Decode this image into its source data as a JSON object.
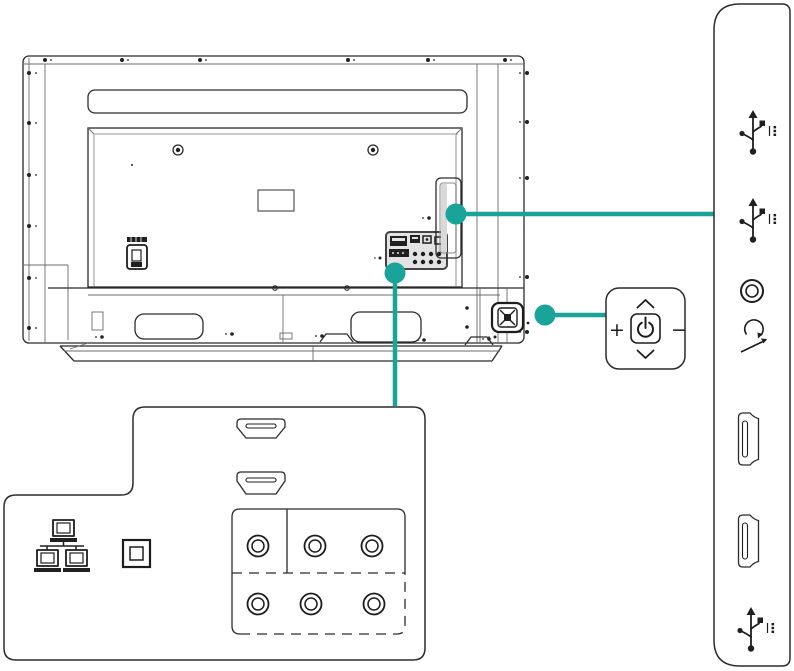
{
  "diagram": {
    "title": "TV rear panel connections diagram",
    "accent_color": "#1AA398",
    "line_color": "#2B2B2B",
    "tv": {
      "view": "rear",
      "features": [
        "speaker-grille-slot",
        "vesa-mount-holes",
        "rating-label",
        "service-port",
        "rear-port-cluster",
        "side-port-cover",
        "power-joystick-button",
        "stand-base"
      ]
    },
    "side_panel": {
      "ports": [
        {
          "icon": "usb-icon",
          "name": "usb-port-1"
        },
        {
          "icon": "usb-icon",
          "name": "usb-port-2"
        },
        {
          "icon": "audio-jack-icon",
          "name": "audio-out-jack"
        },
        {
          "icon": "av-in-icon",
          "name": "av-input"
        },
        {
          "icon": "hdmi-icon",
          "name": "hdmi-port-1"
        },
        {
          "icon": "hdmi-icon",
          "name": "hdmi-port-2"
        },
        {
          "icon": "usb-icon",
          "name": "usb-port-3"
        }
      ]
    },
    "control_panel": {
      "plus_label": "+",
      "minus_label": "−",
      "power_icon": "power-symbol",
      "up_icon": "chevron-up",
      "down_icon": "chevron-down"
    },
    "bottom_panel": {
      "ports": [
        {
          "icon": "ethernet-icon",
          "name": "lan-port"
        },
        {
          "icon": "optical-audio-icon",
          "name": "digital-audio-out"
        },
        {
          "icon": "hdmi-icon",
          "name": "hdmi-port-3"
        },
        {
          "icon": "hdmi-icon",
          "name": "hdmi-port-4"
        },
        {
          "icon": "rca-jack-icon",
          "name": "component-av-jacks",
          "jack_count": 6
        }
      ]
    }
  }
}
